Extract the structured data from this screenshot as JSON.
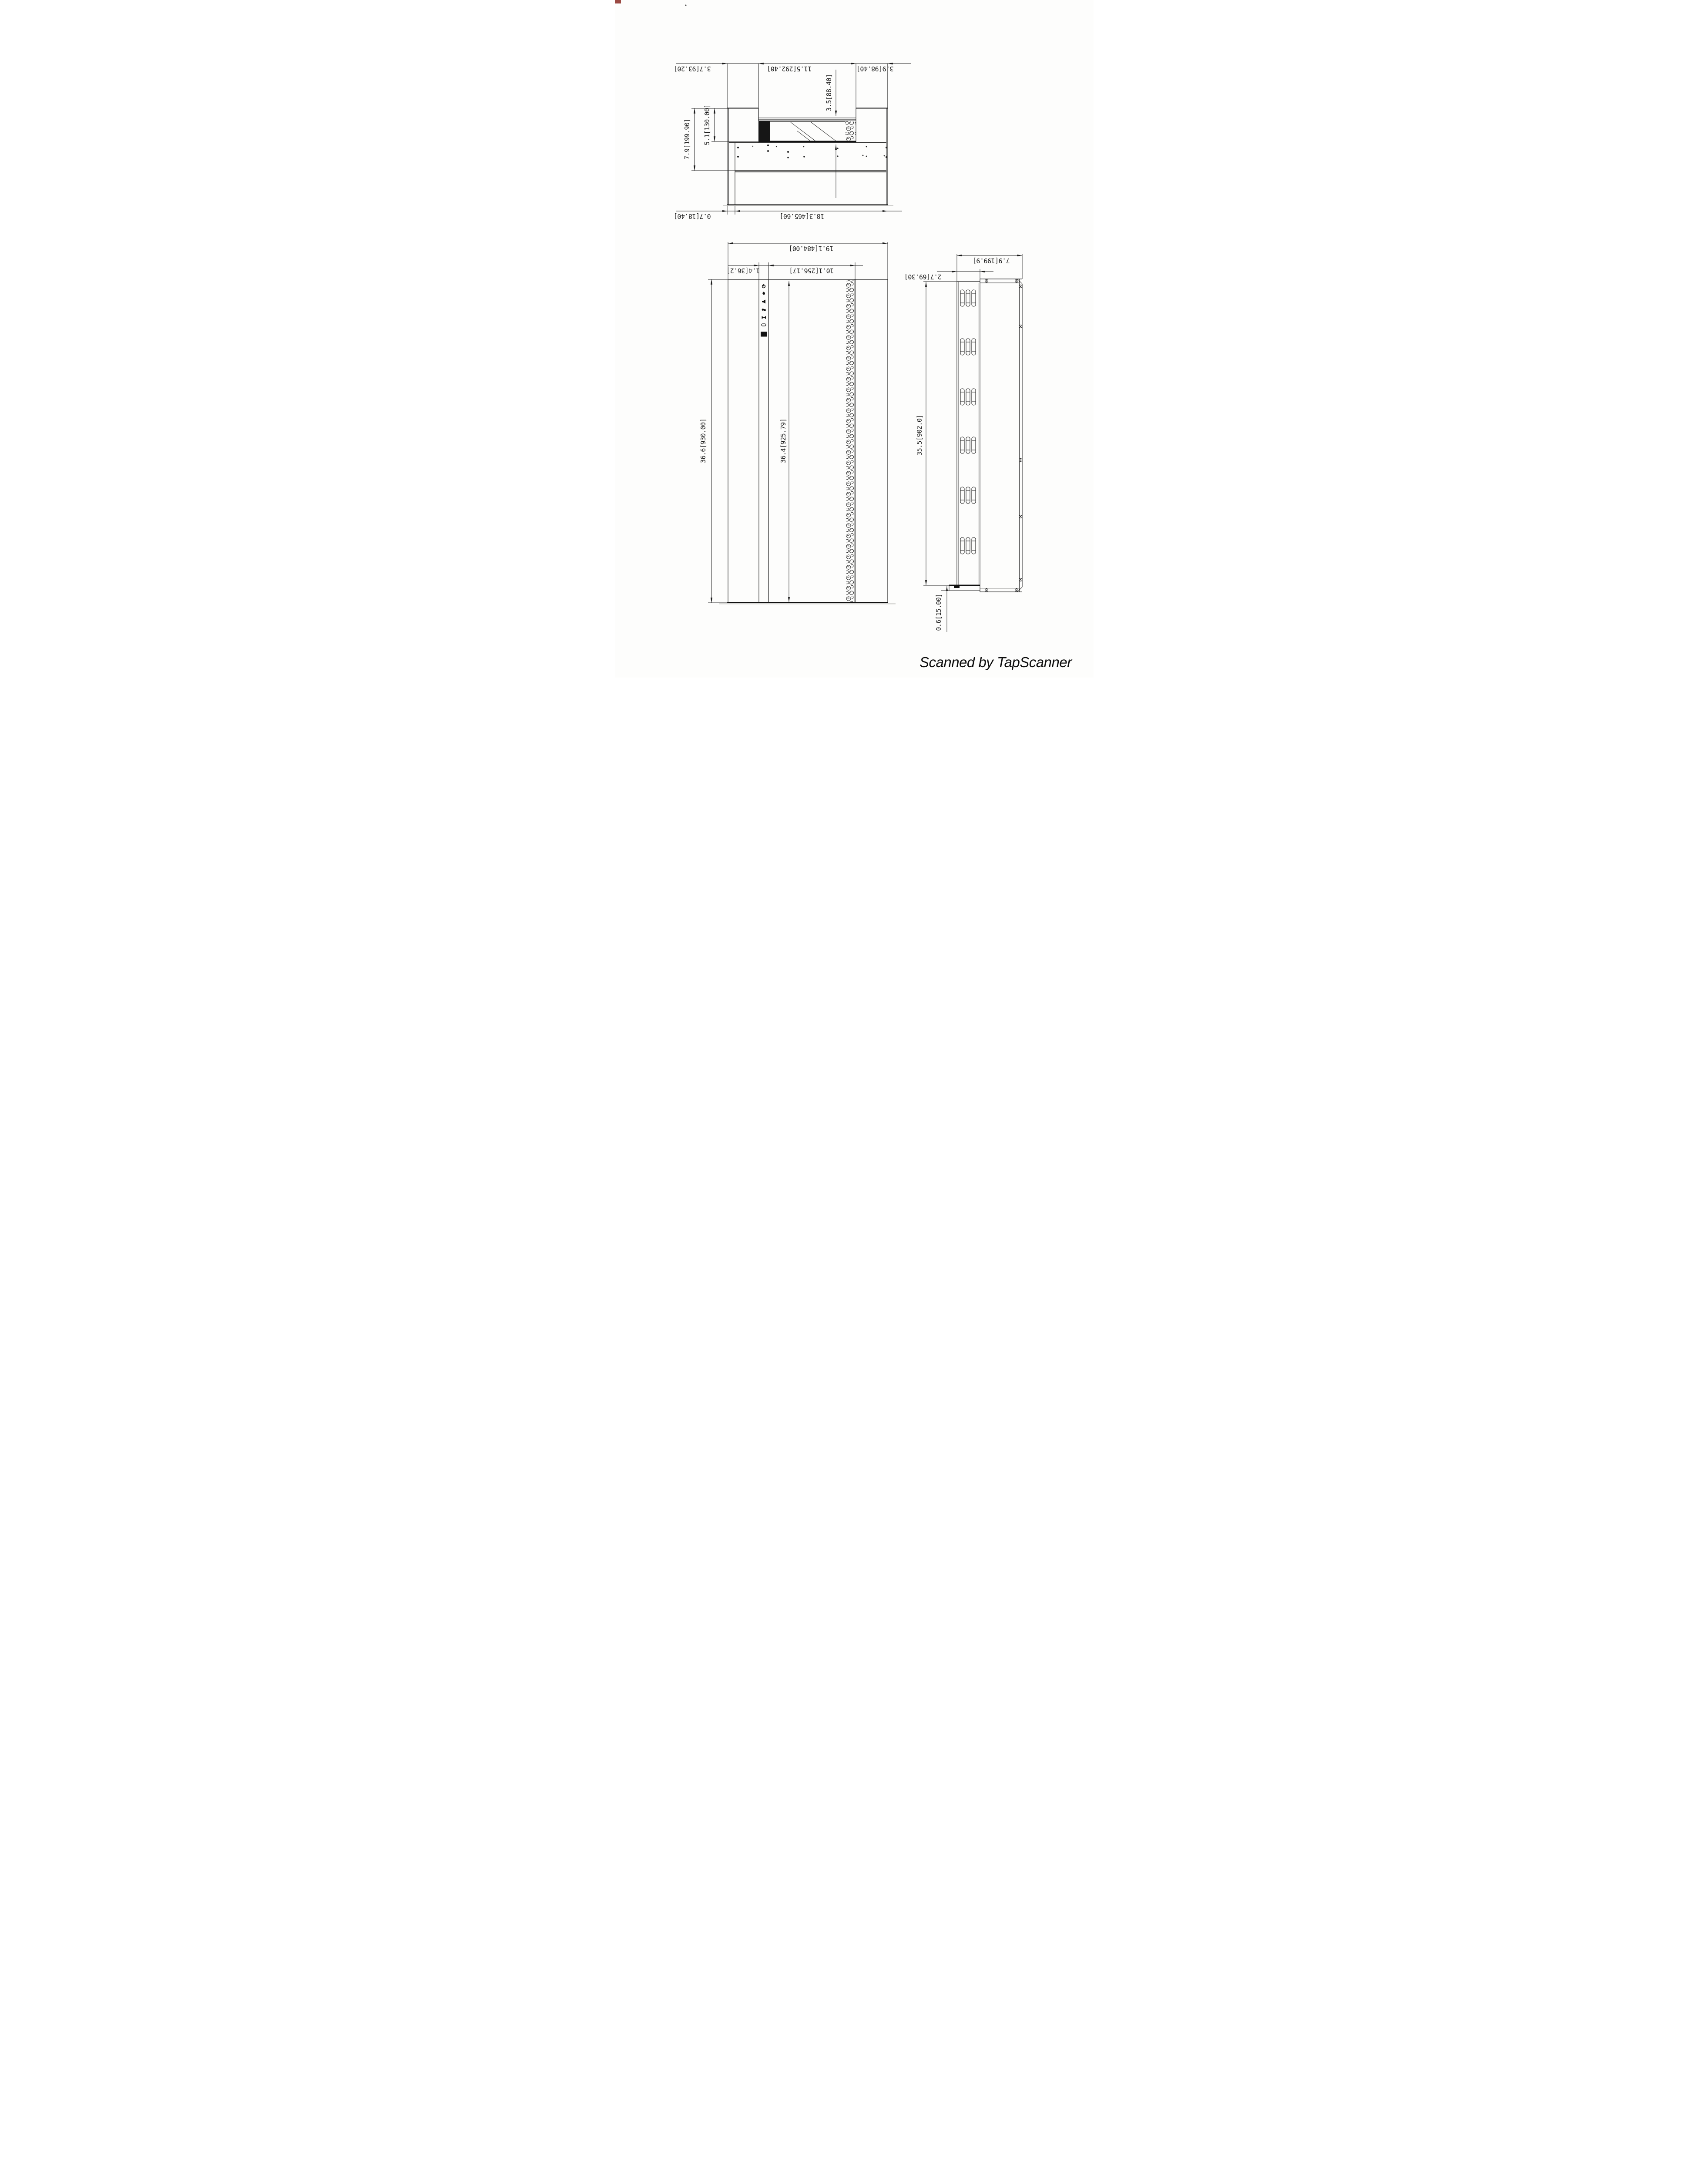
{
  "page": {
    "background": "#fdfdfc",
    "ink": "#1c1c1c",
    "credit": "Scanned by TapScanner"
  },
  "views": {
    "top": {
      "title": "top-section-view",
      "dims": {
        "left_frame_width": "3.7[93.20]",
        "opening_width": "11.5[292.40]",
        "right_frame_width": "3.9[98.40]",
        "overall_depth": "7.9[199.90]",
        "recess_depth": "5.1[130.00]",
        "glass_inset": "3.5[88.40]",
        "back_inset": "0.7[18.40]",
        "back_panel_width": "18.3[465.60]"
      }
    },
    "front": {
      "title": "front-view",
      "dims": {
        "overall_width": "19.1[484.00]",
        "control_strip_width": "1.4[36.2]",
        "glass_opening_width": "10.1[256.17]",
        "overall_height": "36.6[930.00]",
        "glass_opening_height": "36.4[925.79]"
      },
      "control_icons": [
        "power",
        "flame",
        "speaker",
        "media",
        "dimmer",
        "timer"
      ]
    },
    "side": {
      "title": "side-view",
      "dims": {
        "overall_depth_with_panel": "7.9[199.9]",
        "body_depth": "2.7[69.30]",
        "body_height": "35.5[902.0]",
        "bottom_flange": "0.6[15.00]"
      }
    }
  }
}
